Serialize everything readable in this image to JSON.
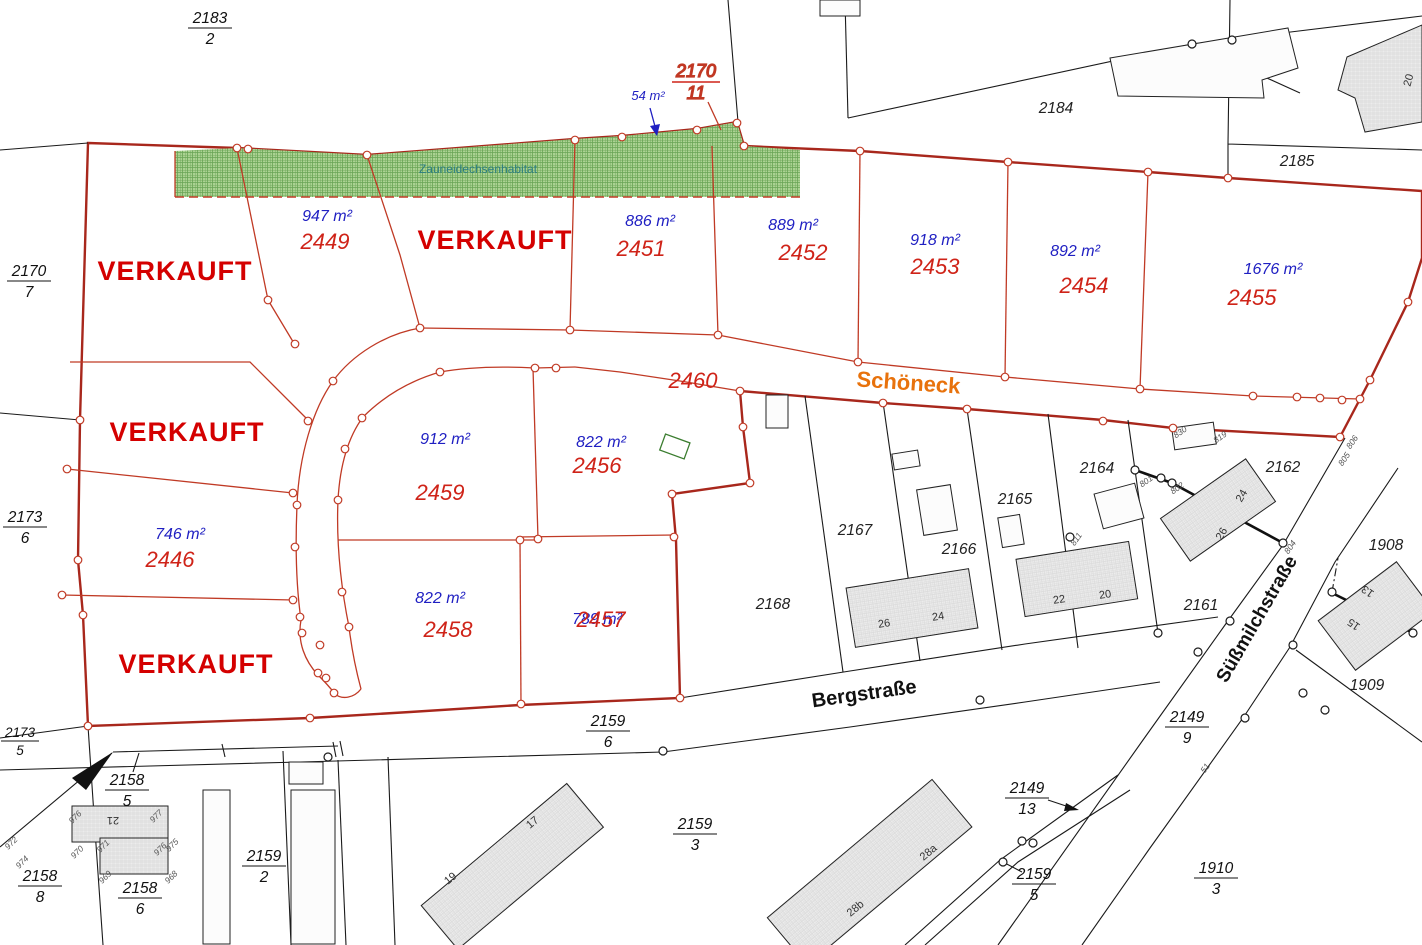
{
  "colors": {
    "sold_red": "#d40000",
    "plot_red": "#cf2318",
    "area_blue": "#1f1fc2",
    "line_red": "#c03a25",
    "boundary_red": "#a8271c",
    "street_orange": "#e8720c",
    "parcel_yellow": "#faf2b8",
    "habitat_green": "#abd292",
    "habitat_hatch": "#69a455",
    "habitat_text": "#2b7d82"
  },
  "sold_label": "VERKAUFT",
  "habitat": {
    "label": "Zauneidechsenhabitat"
  },
  "streets": {
    "schoeneck": "Schöneck",
    "bergstrasse": "Bergstraße",
    "suessmilch": "Süßmilchstraße"
  },
  "road_parcel": "2460",
  "plots": {
    "p2449": {
      "num": "2449",
      "area": "947 m²"
    },
    "p2451": {
      "num": "2451",
      "area": "886 m²"
    },
    "p2452": {
      "num": "2452",
      "area": "889 m²"
    },
    "p2453": {
      "num": "2453",
      "area": "918 m²"
    },
    "p2454": {
      "num": "2454",
      "area": "892 m²"
    },
    "p2455": {
      "num": "2455",
      "area": "1676 m²"
    },
    "p2456": {
      "num": "2456",
      "area": "822 m²"
    },
    "p2457": {
      "num": "2457",
      "area": "789 m²"
    },
    "p2458": {
      "num": "2458",
      "area": "822 m²"
    },
    "p2459": {
      "num": "2459",
      "area": "912 m²"
    },
    "p2446": {
      "num": "2446",
      "area": "746 m²"
    }
  },
  "fractions": {
    "f2183_2": {
      "n": "2183",
      "d": "2"
    },
    "f2170_7": {
      "n": "2170",
      "d": "7"
    },
    "f2170_11": {
      "n": "2170",
      "d": "11"
    },
    "f2173_6": {
      "n": "2173",
      "d": "6"
    },
    "f2173_5": {
      "n": "2173",
      "d": "5"
    },
    "f2158_5": {
      "n": "2158",
      "d": "5"
    },
    "f2158_8": {
      "n": "2158",
      "d": "8"
    },
    "f2158_6": {
      "n": "2158",
      "d": "6"
    },
    "f2159_2": {
      "n": "2159",
      "d": "2"
    },
    "f2159_6": {
      "n": "2159",
      "d": "6"
    },
    "f2159_3": {
      "n": "2159",
      "d": "3"
    },
    "f2159_5": {
      "n": "2159",
      "d": "5"
    },
    "f2149_9": {
      "n": "2149",
      "d": "9"
    },
    "f2149_13": {
      "n": "2149",
      "d": "13"
    },
    "f1910_3": {
      "n": "1910",
      "d": "3"
    }
  },
  "parcels": {
    "p2184": "2184",
    "p2185": "2185",
    "p2168": "2168",
    "p2167": "2167",
    "p2166": "2166",
    "p2165": "2165",
    "p2164": "2164",
    "p2162": "2162",
    "p2161": "2161",
    "p1908": "1908",
    "p1909": "1909"
  },
  "annotations": {
    "area54": "54 m²"
  },
  "house_numbers": {
    "h21": "21",
    "h19": "19",
    "h17": "17",
    "h26": "26",
    "h24": "24",
    "h22": "22",
    "h20": "20",
    "h24b": "24",
    "h26b": "26",
    "h28a": "28a",
    "h28b": "28b",
    "h13": "13",
    "h15": "15",
    "h20b": "20"
  },
  "point_numbers": {
    "n830": "830",
    "n819": "819",
    "n806": "806",
    "n805": "805",
    "n804": "804",
    "n811": "811",
    "n801": "801",
    "n802": "802",
    "n51": "51",
    "n968": "968",
    "n969": "969",
    "n970": "970",
    "n971": "971",
    "n972": "972",
    "n974": "974",
    "n975": "975",
    "n976a": "976",
    "n976b": "976",
    "n977": "977"
  }
}
